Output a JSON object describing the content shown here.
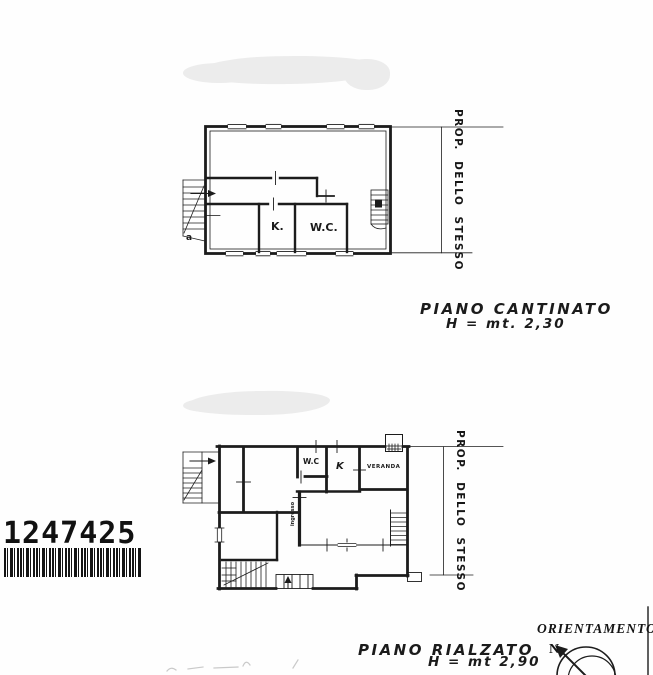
{
  "barcode": {
    "number": "1247425"
  },
  "plans": {
    "cantinato": {
      "caption": "PIANO CANTINATO",
      "height_note": "H = mt. 2,30",
      "boundary_label": "PROP. DELLO STESSO",
      "rooms": {
        "kitchen": "K.",
        "wc": "W.C."
      },
      "stair_mark": "a"
    },
    "rialzato": {
      "caption": "PIANO RIALZATO",
      "height_note": "H = mt 2,90",
      "boundary_label": "PROP. DELLO STESSO",
      "rooms": {
        "wc": "W.C",
        "kitchen": "K",
        "veranda": "VERANDA",
        "entrance": "ingresso"
      }
    }
  },
  "orientation": {
    "title": "ORIENTAMENTO",
    "north": "N"
  },
  "colors": {
    "ink": "#1a1a1a",
    "redaction": "#ececec",
    "paper": "#ffffff"
  }
}
